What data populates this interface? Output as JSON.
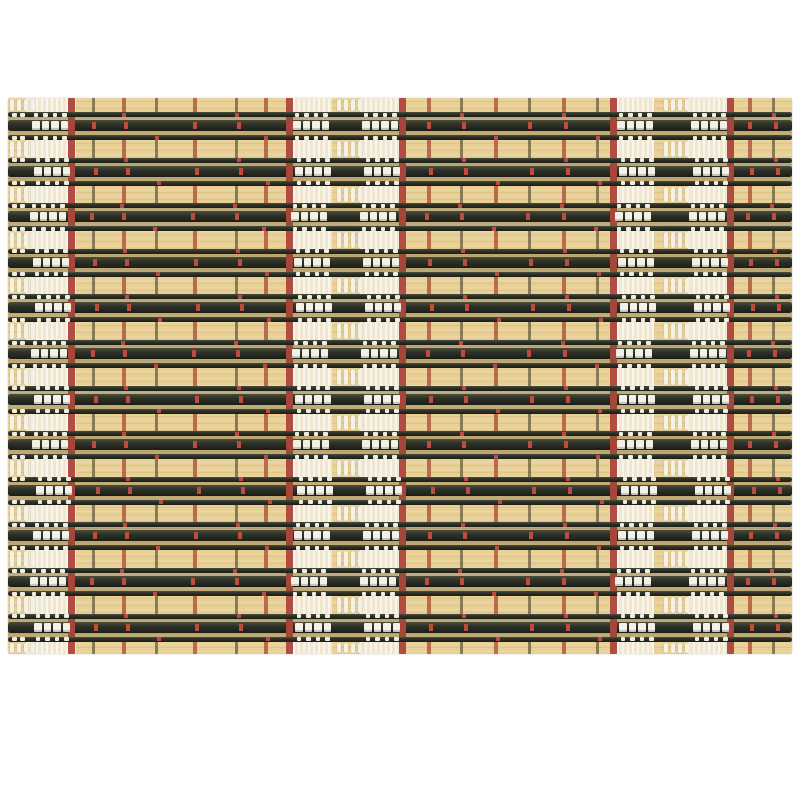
{
  "meta": {
    "subject": "Woven bamboo placemat product photo: natural tan bamboo slats alternating with dark black-green rod groups, red warp threads and white stitch clusters, on a plain white background"
  },
  "canvas": {
    "width": 800,
    "height": 800,
    "background": "#ffffff"
  },
  "mat": {
    "x": 8,
    "y": 98,
    "width": 784,
    "height": 556,
    "base_color": "#e8d096",
    "grain_light": "rgba(255,255,255,0.14)",
    "grain_dark": "rgba(130,95,40,0.10)",
    "edge_radius": 2
  },
  "rows": {
    "count": 12,
    "first_dark_top": 14,
    "spacing": 45.6,
    "dark_height": 28,
    "row_bg": "rgba(95,78,42,0.30)",
    "rods": [
      {
        "top": 0,
        "height": 5
      },
      {
        "top": 8,
        "height": 11
      },
      {
        "top": 23,
        "height": 5
      }
    ],
    "rod_gradient_top": "#4a4e3d",
    "rod_color": "#2d3127",
    "rod_gradient_bottom": "#1b1e16",
    "jitter_x": [
      0,
      2,
      -2,
      1,
      3,
      -1,
      2,
      0,
      4,
      1,
      -2,
      2
    ]
  },
  "light_bands": {
    "cream_patch_color": "#f0e7d0",
    "patches": [
      {
        "x": 26,
        "width": 50
      },
      {
        "x": 288,
        "width": 44
      },
      {
        "x": 360,
        "width": 44
      },
      {
        "x": 612,
        "width": 42
      },
      {
        "x": 688,
        "width": 42
      }
    ],
    "tuft_centers": [
      10,
      337,
      664
    ],
    "tuft": {
      "dash_width": 3.5,
      "dash_pitch": 7,
      "dash_count": 4,
      "color": "#f4f1e7"
    },
    "seams": [
      {
        "x": 92,
        "tone": "dark"
      },
      {
        "x": 122,
        "tone": "red"
      },
      {
        "x": 155,
        "tone": "dark"
      },
      {
        "x": 193,
        "tone": "red"
      },
      {
        "x": 235,
        "tone": "dark"
      },
      {
        "x": 264,
        "tone": "red"
      },
      {
        "x": 427,
        "tone": "red"
      },
      {
        "x": 460,
        "tone": "dark"
      },
      {
        "x": 494,
        "tone": "red"
      },
      {
        "x": 528,
        "tone": "dark"
      },
      {
        "x": 562,
        "tone": "red"
      },
      {
        "x": 596,
        "tone": "dark"
      },
      {
        "x": 748,
        "tone": "red"
      },
      {
        "x": 772,
        "tone": "dark"
      }
    ],
    "seam_dark_color": "rgba(58,52,30,0.55)",
    "seam_red_color": "rgba(168,74,52,0.75)"
  },
  "warp_threads": {
    "red_xs": [
      68,
      286,
      399,
      610,
      727
    ],
    "width": 7,
    "color": "#ad453a"
  },
  "stitches": {
    "cluster_xs": [
      32,
      293,
      362,
      617,
      691
    ],
    "squares_per_cluster": 4,
    "square_width": 7.5,
    "square_height": 9,
    "square_pitch": 9.5,
    "square_color": "#f3f0e6",
    "thin_dash_color": "#efece2",
    "edge_dash_xs": [
      4,
      12
    ],
    "red_dash_color": "#bf4b3e",
    "red_crossing_color": "#a84438"
  }
}
